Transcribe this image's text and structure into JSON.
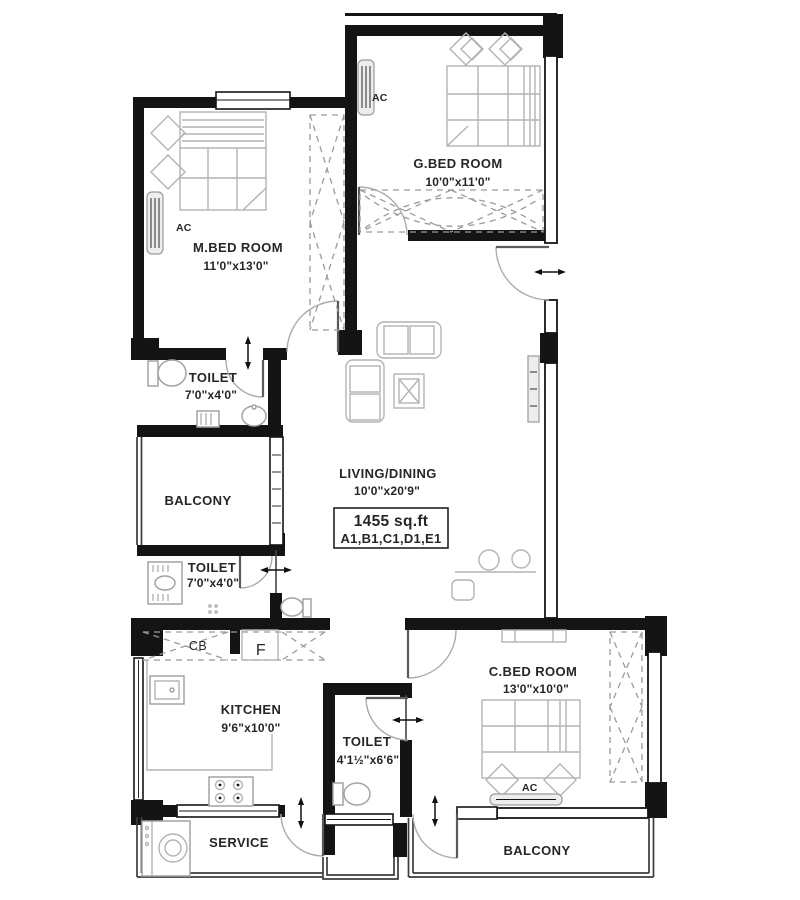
{
  "plan": {
    "area": {
      "value": "1455 sq.ft",
      "codes": "A1,B1,C1,D1,E1"
    },
    "rooms": {
      "m_bed": {
        "name": "M.BED ROOM",
        "dims": "11'0\"x13'0\""
      },
      "g_bed": {
        "name": "G.BED ROOM",
        "dims": "10'0\"x11'0\""
      },
      "c_bed": {
        "name": "C.BED ROOM",
        "dims": "13'0\"x10'0\""
      },
      "toilet_master": {
        "name": "TOILET",
        "dims": "7'0\"x4'0\""
      },
      "toilet_common": {
        "name": "TOILET",
        "dims": "7'0\"x4'0\""
      },
      "toilet_c_bed": {
        "name": "TOILET",
        "dims": "4'1½\"x6'6\""
      },
      "kitchen": {
        "name": "KITCHEN",
        "dims": "9'6\"x10'0\""
      },
      "living": {
        "name": "LIVING/DINING",
        "dims": "10'0\"x20'9\""
      },
      "balcony_west": {
        "name": "BALCONY"
      },
      "balcony_south": {
        "name": "BALCONY"
      },
      "service": {
        "name": "SERVICE"
      }
    },
    "labels": {
      "ac": "AC",
      "cb": "CB",
      "fridge": "F"
    }
  }
}
